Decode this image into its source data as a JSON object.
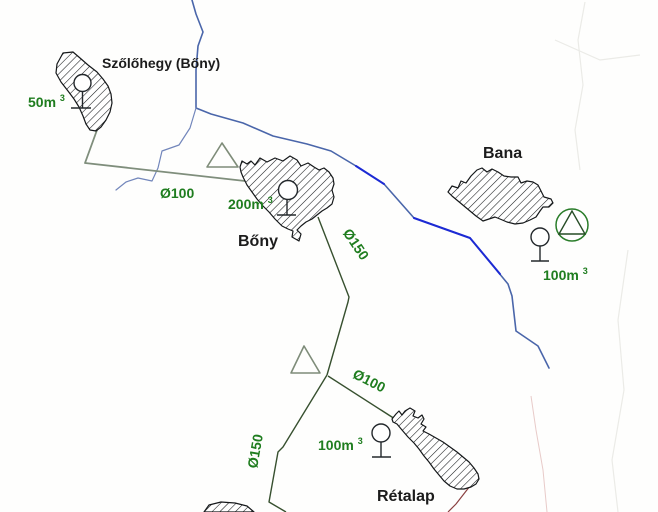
{
  "map": {
    "kind": "water-supply-network-schematic",
    "colors": {
      "label_green": "#1f7d1f",
      "label_black": "#1c1c1c",
      "pipe_dark_green": "#37502f",
      "pipe_gray_green": "#7f8e7c",
      "river_blue": "#4a66aa",
      "river_bright_blue": "#1c2ad4",
      "boundary_red": "#8a4040",
      "hatch_black": "#15181a"
    },
    "symbols": {
      "reservoir": "circle-on-stand-icon",
      "well_pump": "circle-with-triangle-icon",
      "booster": "triangle-icon"
    },
    "settlements": [
      {
        "name": "Szőlőhegy (Bőny)",
        "capacity": "50m",
        "capacity_sup": "3"
      },
      {
        "name": "Bőny",
        "capacity": "200m",
        "capacity_sup": "3"
      },
      {
        "name": "Bana",
        "capacity": "100m",
        "capacity_sup": "3"
      },
      {
        "name": "Rétalap",
        "capacity": "100m",
        "capacity_sup": "3"
      }
    ],
    "pipes": [
      {
        "id": "szolohegy-to-bony",
        "label": "Ø100"
      },
      {
        "id": "bony-to-junction",
        "label": "Ø150"
      },
      {
        "id": "junction-to-retalap",
        "label": "Ø100"
      },
      {
        "id": "junction-to-south",
        "label": "Ø150"
      }
    ]
  }
}
